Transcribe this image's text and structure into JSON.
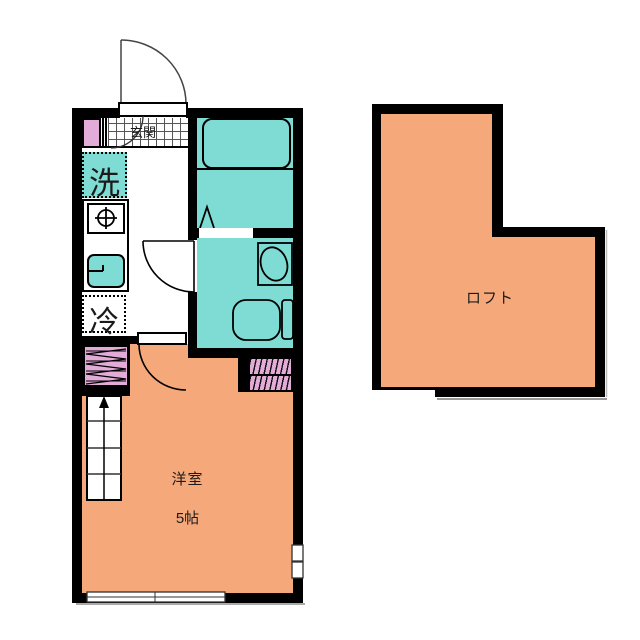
{
  "floorplan": {
    "main_unit": {
      "entrance": {
        "label": "玄関"
      },
      "laundry": {
        "label": "洗"
      },
      "refrigerator": {
        "label": "冷"
      },
      "living_room": {
        "label": "洋室",
        "size": "5帖"
      }
    },
    "loft": {
      "label": "ロフト"
    },
    "colors": {
      "floor_orange": "#F5A97B",
      "wet_area_teal": "#7EDCD4",
      "storage_pink": "#E2ABD8",
      "wall_black": "#000000"
    }
  }
}
